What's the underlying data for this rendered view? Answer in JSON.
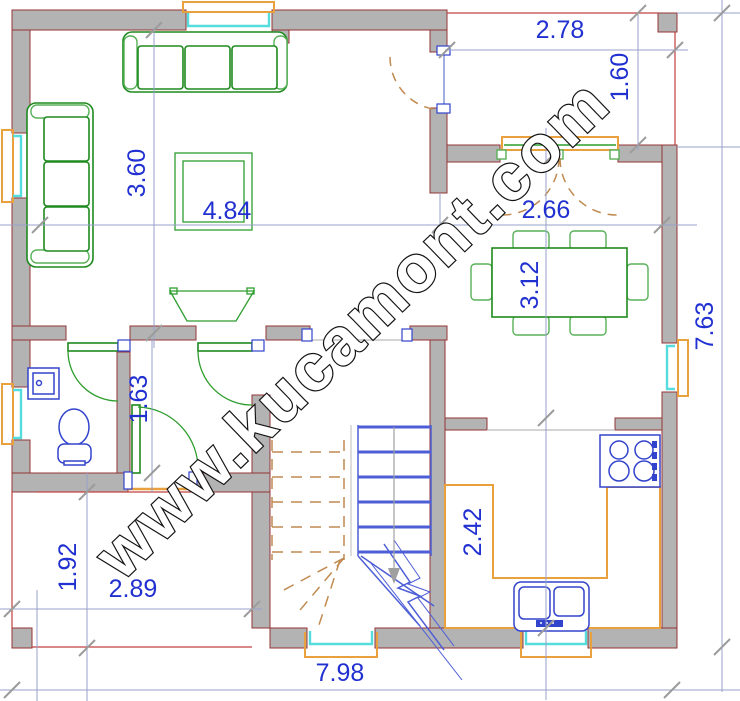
{
  "watermark": "www.kucamont.com",
  "dims": {
    "balcony_width": "2.78",
    "balcony_depth": "1.60",
    "living_height": "3.60",
    "living_width": "4.84",
    "hall_width": "2.66",
    "dining_height": "3.12",
    "house_height": "7.63",
    "bath_height": "1.63",
    "porch_height": "1.92",
    "porch_width": "2.89",
    "kitchen_height": "2.42",
    "house_width": "7.98"
  },
  "colors": {
    "wall_fill": "#b3b3b3",
    "wall_edge": "#953434",
    "dimension_text": "#2130d0",
    "dimension_line": "#98a0c8",
    "furniture_green": "#1e8a1e",
    "fixture_blue": "#3344cc",
    "counter_orange": "#e8a13c",
    "window_cyan": "#55dcdc",
    "stair_dash_tan": "#c08a50",
    "watermark_fill": "#ffffff"
  }
}
